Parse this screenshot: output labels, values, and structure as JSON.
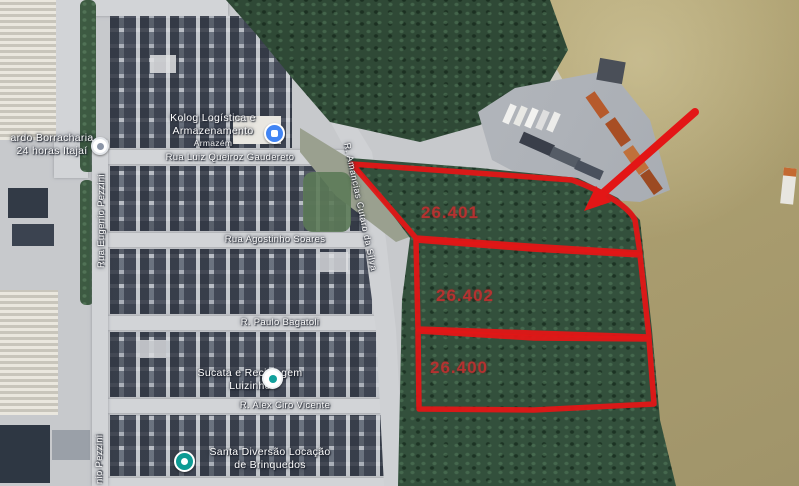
{
  "annotation": {
    "stroke_color": "#e31616",
    "label_color": "#bf3030",
    "parcels": [
      {
        "label": "26.401"
      },
      {
        "label": "26.402"
      },
      {
        "label": "26.400"
      }
    ],
    "arrow": {
      "name": "red-arrow",
      "direction": "pointing-down-left-at-parcel-26401"
    }
  },
  "streets": {
    "gaudereto": "Rua Luiz Queiroz Gaudereto",
    "soares": "Rua Agostinho Soares",
    "bagatoli": "R. Paulo Bagatoli",
    "vicente": "R. Alex Ciro Vicente",
    "pezzini": "Rua Eugenio Pezzini",
    "pezzini_partial": "nio Pezzini",
    "amancias": "R. Amancias Cutaro da Silva"
  },
  "places": {
    "borracharia": {
      "line1": "ardo Borracharia",
      "line2": "24 horas Itajaí",
      "pin": "place-pin-white"
    },
    "kolog": {
      "line1": "Kolog Logística e",
      "line2": "Armazenamento",
      "sub": "Armazém",
      "pin": "logistics-pin-blue"
    },
    "sucata": {
      "line1": "Sucata e Reciclagem",
      "line2": "Luizinho",
      "pin": "place-pin-teal-dot"
    },
    "santa": {
      "line1": "Santa Diversão Locação",
      "line2": "de Brinquedos",
      "pin": "store-pin-teal"
    }
  },
  "terrain_colors": {
    "water": "#ab9e6f",
    "forest": "#2f4936",
    "urban": "#c7c9cc",
    "dock": "#b6bac0",
    "road": "#d2d4d7"
  }
}
